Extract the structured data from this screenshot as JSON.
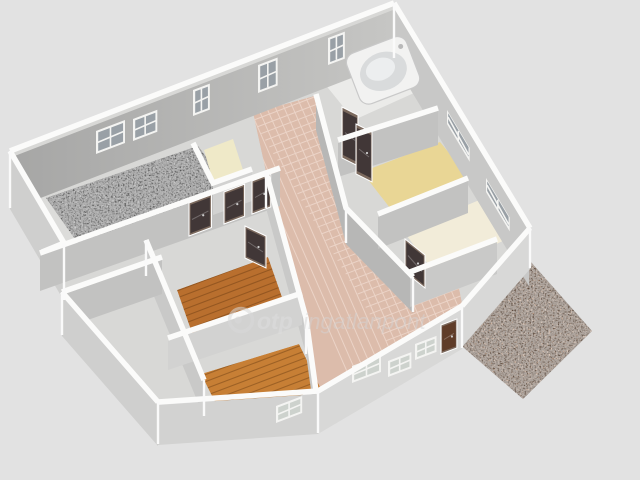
{
  "scene": {
    "description": "3D rendered floor plan of an apartment, aerial oblique view",
    "background": "#e2e2e2"
  },
  "watermark": {
    "icon": "otp-circle-logo-icon",
    "brand": "otp",
    "suffix": "ingatlanpont"
  },
  "palette": {
    "bg": "#e2e2e2",
    "band": "#fbfbfa",
    "baseInterior": "#d8d8d6",
    "facadeA": "#a6a6a5",
    "facadeB": "#c6c6c4",
    "neFace": "#c8c8c7",
    "swFace": "#cfcfce",
    "swInner": "#dcdcda",
    "faceS": "#c2c2c1",
    "faceW": "#c9c9c8",
    "faceD": "#b7b7b6",
    "faceL": "#d2d2d1",
    "faceXL": "#d8d8d7",
    "floorGray": "#9f9f9f",
    "pinkTile": "#dcbcab",
    "pinkGrout": "#eed8cc",
    "tanFloor": "#e9d695",
    "creamFloor": "#f2ecd9",
    "paleFloor": "#efe9c8",
    "bathFloor": "#ebebe9",
    "wood1": "#b96f2e",
    "wood2": "#c77f35",
    "plankLine": "rgba(96,52,14,0.4)",
    "windowFrame": "#f4f4f2",
    "windowPane": "#99a0a6",
    "windowPaneLight": "#cdd2cd",
    "doorDark": "#413737",
    "doorBrown": "#5f3c28",
    "doorFrame": "#7c6a5e",
    "doorLine": "rgba(255,255,255,0.25)",
    "tubOuter": "#f2f2f1",
    "tubRim": "#c9c9c9",
    "tubInner": "#d9dbdc",
    "tubBowl": "#eceeef",
    "faucet": "#b9b9b9",
    "terrace": "#c7a084",
    "edge": "#fafafa",
    "watermark": "#d9d9d9",
    "watermarkText": "#dedede",
    "watermarkText2": "#d4d4d4"
  },
  "rooms": [
    {
      "name": "living-room",
      "floor": "gray-carpet"
    },
    {
      "name": "side-room",
      "floor": "gray"
    },
    {
      "name": "hallway",
      "floor": "pink-tile"
    },
    {
      "name": "hall",
      "floor": "pink-tile"
    },
    {
      "name": "bathroom",
      "floor": "white",
      "fixture": "corner-bathtub"
    },
    {
      "name": "pantry",
      "floor": "pale-yellow"
    },
    {
      "name": "bedroom-1",
      "floor": "tan"
    },
    {
      "name": "bedroom-2",
      "floor": "cream"
    },
    {
      "name": "bedroom-3",
      "floor": "wood"
    },
    {
      "name": "bedroom-4",
      "floor": "wood"
    },
    {
      "name": "terrace",
      "floor": "speckled-stone"
    }
  ],
  "counts": {
    "windows": 11,
    "doors": 8,
    "bathtubs": 1
  }
}
